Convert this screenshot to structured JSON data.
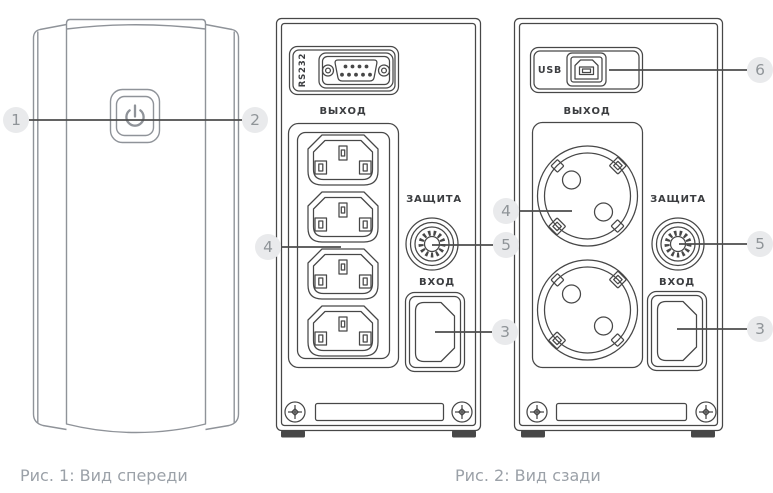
{
  "colors": {
    "line": "#474747",
    "tower_line": "#8f9399",
    "leader": "#4d4d4d",
    "badge_bg": "#e9eaec",
    "badge_fg": "#8f9498",
    "label": "#3b3d40",
    "caption": "#9ba1a8"
  },
  "figure1": {
    "caption": "Рис. 1: Вид спереди",
    "callout_left": "1",
    "callout_right": "2"
  },
  "figure2": {
    "caption": "Рис. 2: Вид сзади",
    "iec_panel": {
      "rs232_label": "RS232",
      "output_label": "ВЫХОД",
      "protection_label": "ЗАЩИТА",
      "input_label": "ВХОД",
      "callout_outlets": "4",
      "callout_breaker": "5",
      "callout_inlet": "3"
    },
    "schuko_panel": {
      "usb_label": "USB",
      "output_label": "ВЫХОД",
      "protection_label": "ЗАЩИТА",
      "input_label": "ВХОД",
      "callout_usb": "6",
      "callout_outlets": "4",
      "callout_breaker": "5",
      "callout_inlet": "3"
    }
  }
}
